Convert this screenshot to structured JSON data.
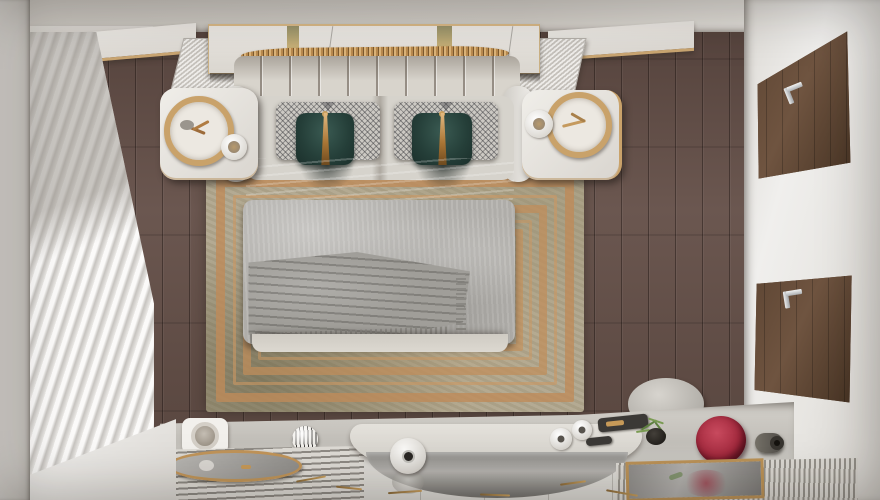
{
  "scene": {
    "title": "Bedroom interior, top-down 3D render",
    "view": "top-down",
    "room_type": "bedroom",
    "visible_text": "none"
  },
  "palette": {
    "floor_wood": "#5f4c45",
    "wall_gray": "#ccc8c2",
    "wall_white": "#eceae7",
    "curtain_white": "#f2f1ef",
    "headboard_cream": "#d8d4cc",
    "pillow_teal": "#2c4a43",
    "pillow_gold_band": "#b98a52",
    "pillow_houndstooth": "#ccc9c3",
    "duvet_gray": "#b6b4b0",
    "throw_gray": "#a09e99",
    "rug_base_olive": "#b0a68d",
    "rug_copper": "#c08d5f",
    "door_walnut": "#5d4533",
    "handle_steel": "#c7c9cb",
    "accent_gold": "#c9a26a",
    "vase_red": "#a42a3e",
    "plant_green": "#5f8040",
    "console_gray": "#cbc8c2"
  },
  "regions": {
    "floor": {
      "label": "dark walnut plank floor"
    },
    "rug": {
      "label": "olive-beige area rug with concentric copper rectangle borders"
    },
    "wall_top": {
      "label": "headboard wall top band"
    },
    "wall_left": {
      "label": "left wall with window"
    },
    "wall_right": {
      "label": "right wall with walnut wardrobe doors"
    },
    "curtain": {
      "label": "sheer white pleated curtains over window"
    },
    "sill": {
      "label": "white window sill ledge"
    },
    "shelf_left": {
      "label": "floating shelf with gold trim (left of headboard)"
    },
    "shelf_right": {
      "label": "floating shelf with gold trim (right of headboard)"
    },
    "hatch_left": {
      "label": "ribbed metal wall panel left"
    },
    "hatch_right": {
      "label": "ribbed metal wall panel right"
    },
    "center_panel": {
      "label": "mirrored headboard panel with gold slatted wave sculpture"
    },
    "headboard": {
      "label": "cream channel-tufted headboard"
    },
    "bed": {
      "label": "double bed with gray duvet and knit throw"
    },
    "pillow_check_1": {
      "label": "houndstooth pillow left"
    },
    "pillow_check_2": {
      "label": "houndstooth pillow right"
    },
    "pillow_teal_1": {
      "label": "teal velvet cushion with gold band, left"
    },
    "pillow_teal_2": {
      "label": "teal velvet cushion with gold band, right"
    },
    "sheet": {
      "label": "folded top sheet"
    },
    "duvet": {
      "label": "light gray duvet"
    },
    "throw": {
      "label": "gray fringed knit throw"
    },
    "footboard": {
      "label": "bed end bench"
    },
    "nightstand_left": {
      "label": "white nightstand, left"
    },
    "nightstand_right": {
      "label": "white nightstand, right"
    },
    "ring_lamp_left": {
      "label": "gold ring table lamp with dried twigs, left"
    },
    "ring_lamp_right": {
      "label": "gold ring table lamp with dried twigs, right"
    },
    "cup_left": {
      "label": "ceramic cup on left nightstand"
    },
    "cup_right": {
      "label": "ceramic cup on right nightstand"
    },
    "door_top": {
      "label": "walnut wardrobe door, upper right"
    },
    "door_bottom": {
      "label": "walnut wardrobe door, lower right"
    },
    "handle_top": {
      "label": "steel lever handle, upper door"
    },
    "handle_bottom": {
      "label": "steel lever handle, lower door"
    },
    "pouf": {
      "label": "round gray pouf"
    },
    "console": {
      "label": "vanity console along bottom wall"
    },
    "outlet": {
      "label": "round wall speaker / outlet plate"
    },
    "sphere_vase": {
      "label": "striped sphere vase"
    },
    "desk": {
      "label": "curved white vanity desk"
    },
    "arc_mirror": {
      "label": "curved mirror front of vanity"
    },
    "vase_white_big": {
      "label": "white round vase with dark mouth"
    },
    "vases_white_small": {
      "label": "pair of small white vases"
    },
    "trays_dark": {
      "label": "dark trays with gold objects"
    },
    "plant": {
      "label": "green plant sprigs in dark pot"
    },
    "vase_red": {
      "label": "crimson textured round vase"
    },
    "knob_vase": {
      "label": "dark cylinder vessel"
    },
    "bench_slatted": {
      "label": "slatted bench with oval gold mirror tray"
    },
    "tray_oval": {
      "label": "gold-rimmed oval mirror tray"
    },
    "bench_ribbed": {
      "label": "ribbed fabric bench, bottom right"
    },
    "mirror_tray_right": {
      "label": "gold-framed mirror tray reflecting red vase"
    },
    "tiles": {
      "label": "white tile floor strip"
    },
    "gold_sticks": {
      "label": "scattered gold sticks decor"
    }
  }
}
